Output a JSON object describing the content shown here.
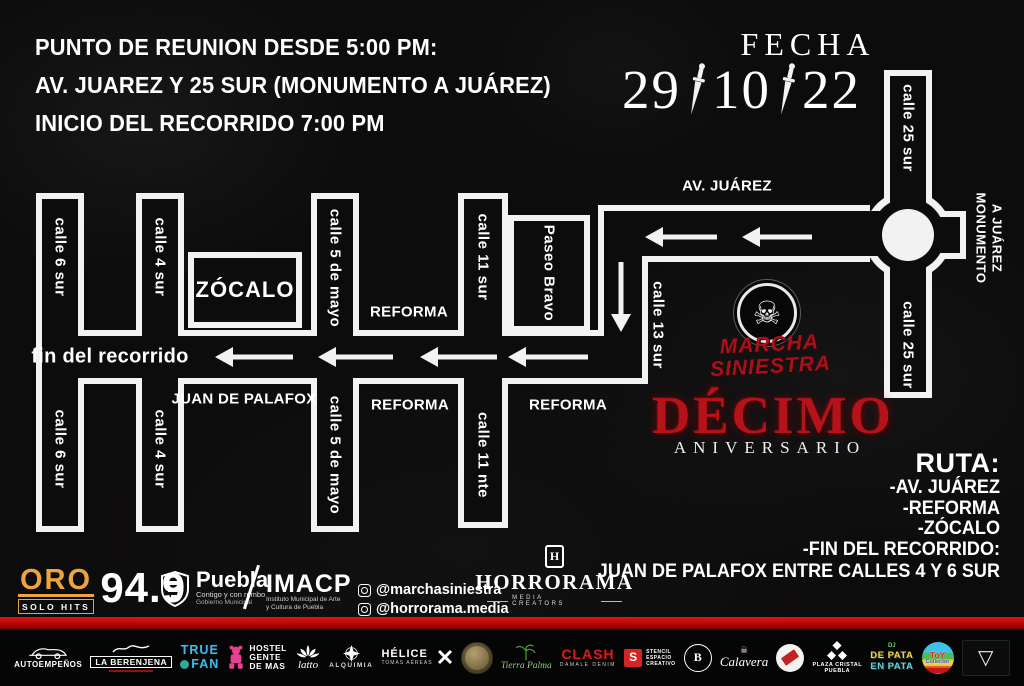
{
  "header": {
    "meeting_lines": [
      "PUNTO DE REUNION DESDE 5:00 PM:",
      "AV. JUAREZ Y 25 SUR (MONUMENTO A JUÁREZ)",
      "INICIO DEL RECORRIDO 7:00 PM"
    ],
    "fecha_label": "FECHA",
    "date_day": "29",
    "date_month": "10",
    "date_year": "22"
  },
  "map": {
    "labels": {
      "calle_25_sur": "calle 25 sur",
      "monumento_line1": "MONUMENTO",
      "monumento_line2": "A JUÁREZ",
      "av_juarez": "AV. JUÁREZ",
      "calle_13_sur": "calle 13 sur",
      "calle_11_sur": "calle 11 sur",
      "calle_11_nte": "calle 11 nte",
      "calle_5_de_mayo": "calle 5 de mayo",
      "calle_4_sur": "calle 4 sur",
      "calle_6_sur": "calle 6 sur",
      "paseo_bravo": "Paseo Bravo",
      "zocalo": "ZÓCALO",
      "reforma": "REFORMA",
      "juan_de_palafox": "JUAN DE PALAFOX",
      "fin_del_recorrido": "fin del recorrido"
    }
  },
  "logo": {
    "skull": "☠",
    "marcha_line1": "MARCHA",
    "marcha_line2": "SINIESTRA",
    "decimo": "DÉCIMO",
    "aniversario": "ANIVERSARIO",
    "red": "#b6121a"
  },
  "ruta": {
    "title": "RUTA:",
    "items": [
      "-AV. JUÁREZ",
      "-REFORMA",
      "-ZÓCALO",
      "-FIN DEL RECORRIDO:"
    ],
    "detail": "JUAN DE PALAFOX ENTRE CALLES 4 Y 6 SUR"
  },
  "partners": {
    "oro": {
      "name": "ORO",
      "tagline": "SOLO HITS",
      "freq": "94.9",
      "gold": "#eda43f"
    },
    "puebla": {
      "name": "Puebla",
      "tagline": "Contigo y con rumbo",
      "sub": "Gobierno Municipal"
    },
    "imacp": {
      "name": "IMACP",
      "sub1": "Instituto Municipal de Arte",
      "sub2": "y Cultura de Puebla"
    },
    "social": {
      "handle1": "@marchasiniestra",
      "handle2": "@horrorama.media"
    },
    "horrorama": {
      "monogram": "H",
      "name": "HORRORAMA",
      "sub": "MEDIA CREATORS"
    }
  },
  "sponsors": [
    {
      "label": "AUTOEMPEÑOS"
    },
    {
      "label": "LA BERENJENA"
    },
    {
      "line1": "TRUE",
      "line2": "FAN"
    },
    {
      "line1": "HOSTEL",
      "line2": "GENTE",
      "line3": "DE MAS"
    },
    {
      "label": "latto"
    },
    {
      "label": "ALQUIMIA"
    },
    {
      "label": "HÉLICE",
      "sub": "TOMAS AÉREAS"
    },
    {},
    {
      "label": "Tierra Palma"
    },
    {
      "label": "CLASH",
      "sub": "DAMALE DENIM"
    },
    {
      "letter": "S",
      "line1": "STENCIL",
      "line2": "ESPACIO",
      "line3": "CREATIVO"
    },
    {
      "letter": "B"
    },
    {
      "skull": "☠",
      "label": "Calavera"
    },
    {},
    {
      "line1": "PLAZA CRISTAL",
      "line2": "PUEBLA"
    },
    {
      "line1": "DE PATA",
      "line2": "EN PATA",
      "dj": "DJ"
    },
    {
      "line1": "ToY",
      "line2": "Collector"
    },
    {
      "glyph": "▽"
    }
  ]
}
